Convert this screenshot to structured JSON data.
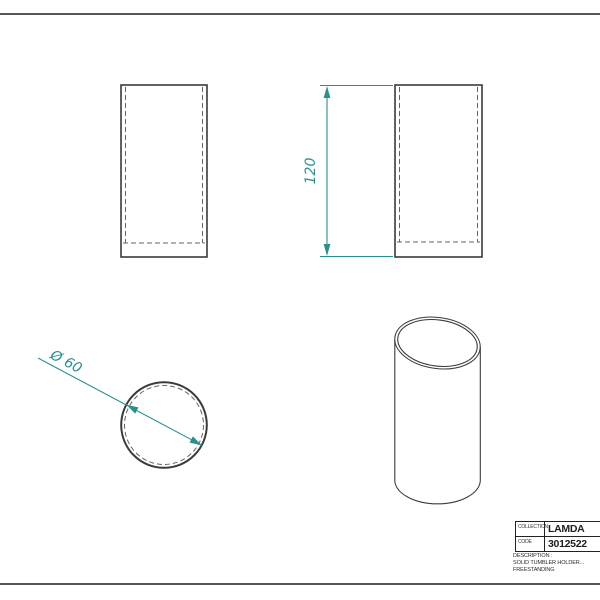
{
  "colors": {
    "dimension": "#2a8f90",
    "drawing_line": "#3b3b3b",
    "hidden_line": "#636363",
    "sheet_border": "#565656",
    "titleblock_line": "#222222"
  },
  "dimensions": {
    "height": "120",
    "diameter": "Ø 60"
  },
  "title_block": {
    "collection_label": "COLLECTION",
    "collection_value": "LAMDA",
    "code_label": "CODE",
    "code_value": "3012522",
    "description_label": "DESCRIPTION :",
    "description_line1": "SOLID TUMBLER HOLDER...",
    "description_line2": "FREESTANDING"
  }
}
